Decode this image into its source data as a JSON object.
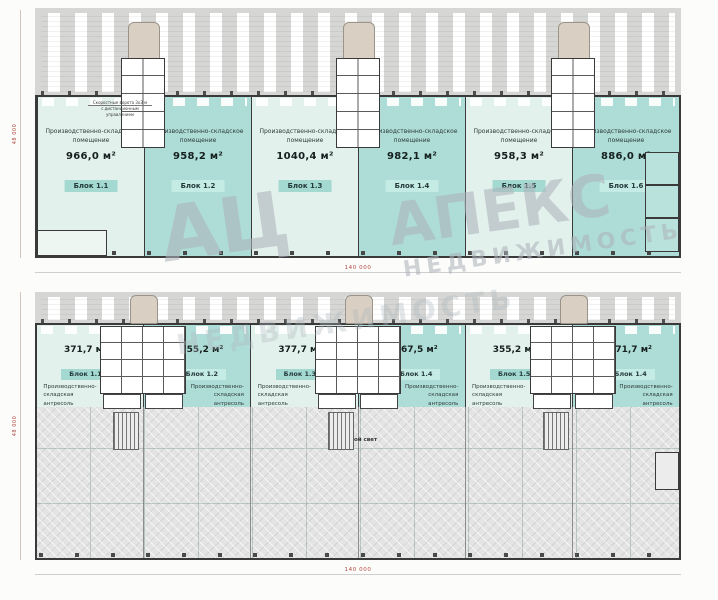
{
  "watermark": {
    "brand_short": "АЦ",
    "brand": "АПЕКС",
    "brand_sub": "НЕДВИЖИМОСТЬ",
    "brand_sub2": "НЕДВИЖИМОСТЬ"
  },
  "floor1": {
    "room_label_line1": "Производственно-складское",
    "room_label_line2": "помещение",
    "note_line1": "Скоростные ворота 3х3 м",
    "note_line2": "с дистанционным управлением",
    "blocks": [
      {
        "area": "966,0 м²",
        "block": "Блок 1.1",
        "tone": "pale"
      },
      {
        "area": "958,2 м²",
        "block": "Блок 1.2",
        "tone": "teal"
      },
      {
        "area": "1040,4 м²",
        "block": "Блок 1.3",
        "tone": "pale"
      },
      {
        "area": "982,1 м²",
        "block": "Блок 1.4",
        "tone": "teal"
      },
      {
        "area": "958,3 м²",
        "block": "Блок 1.5",
        "tone": "pale"
      },
      {
        "area": "886,0 м²",
        "block": "Блок 1.6",
        "tone": "teal"
      }
    ],
    "dim_bottom": "140 000",
    "dim_left": "48 000"
  },
  "floor2": {
    "room_label_line1": "Производственно-складская",
    "room_label_line2": "антресоль",
    "void_label": "Второй свет",
    "blocks": [
      {
        "area": "371,7 м²",
        "block": "Блок 1.1",
        "tone": "pale"
      },
      {
        "area": "355,2 м²",
        "block": "Блок 1.2",
        "tone": "teal"
      },
      {
        "area": "377,7 м²",
        "block": "Блок 1.3",
        "tone": "pale"
      },
      {
        "area": "367,5 м²",
        "block": "Блок 1.4",
        "tone": "teal"
      },
      {
        "area": "355,2 м²",
        "block": "Блок 1.5",
        "tone": "pale"
      },
      {
        "area": "371,7 м²",
        "block": "Блок 1.4",
        "tone": "teal"
      }
    ],
    "dim_bottom": "140 000",
    "dim_left": "48 000"
  },
  "colors": {
    "block_teal": "#aedcd6",
    "block_pale": "#e3f1ec",
    "apron_gray": "#d6d6d5",
    "void_gray": "#e4e4e4",
    "dimension_red": "#b0493f",
    "wall_dark": "#3a3a3a"
  }
}
